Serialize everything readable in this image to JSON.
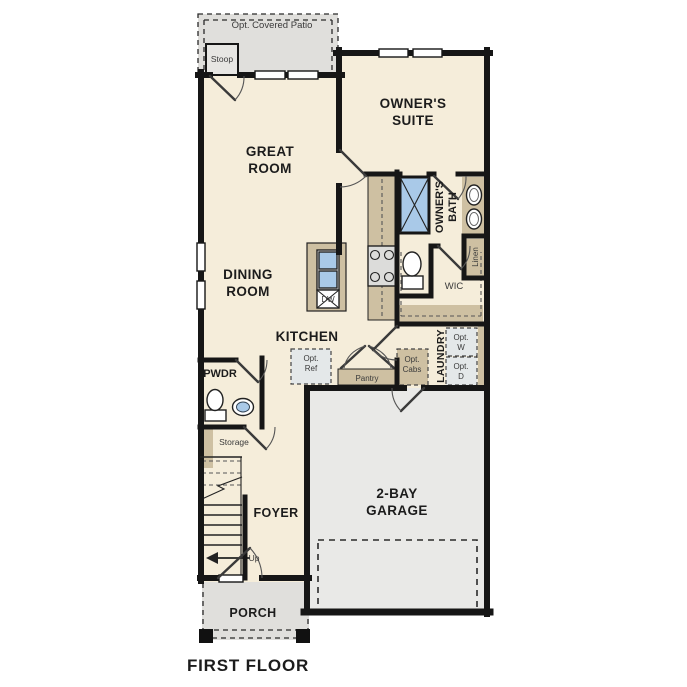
{
  "title": "FIRST FLOOR",
  "colors": {
    "interior_floor": "#f5edda",
    "exterior_concrete": "#e0dfdc",
    "garage_floor": "#e9e9e7",
    "counter_tan": "#cec0a2",
    "fixture_blue": "#a9c9e8",
    "appliance_gray": "#e4e8e9",
    "wall_black": "#161616"
  },
  "rooms": {
    "patio": "Opt. Covered Patio",
    "stoop": "Stoop",
    "great_room": {
      "l1": "GREAT",
      "l2": "ROOM"
    },
    "owners_suite": {
      "l1": "OWNER'S",
      "l2": "SUITE"
    },
    "dining_room": {
      "l1": "DINING",
      "l2": "ROOM"
    },
    "kitchen": "KITCHEN",
    "owners_bath": {
      "l1": "OWNER'S",
      "l2": "BATH"
    },
    "linen": "Linen",
    "wic": "WIC",
    "laundry": "LAUNDRY",
    "pwdr": "PWDR",
    "storage": "Storage",
    "foyer": "FOYER",
    "garage": {
      "l1": "2-BAY",
      "l2": "GARAGE"
    },
    "porch": "PORCH"
  },
  "annotations": {
    "up": "Up",
    "dw": "DW",
    "pantry": "Pantry",
    "opt_ref": {
      "l1": "Opt.",
      "l2": "Ref"
    },
    "opt_cabs": {
      "l1": "Opt.",
      "l2": "Cabs"
    },
    "opt_washer": {
      "l1": "Opt.",
      "l2": "W"
    },
    "opt_dryer": {
      "l1": "Opt.",
      "l2": "D"
    }
  }
}
